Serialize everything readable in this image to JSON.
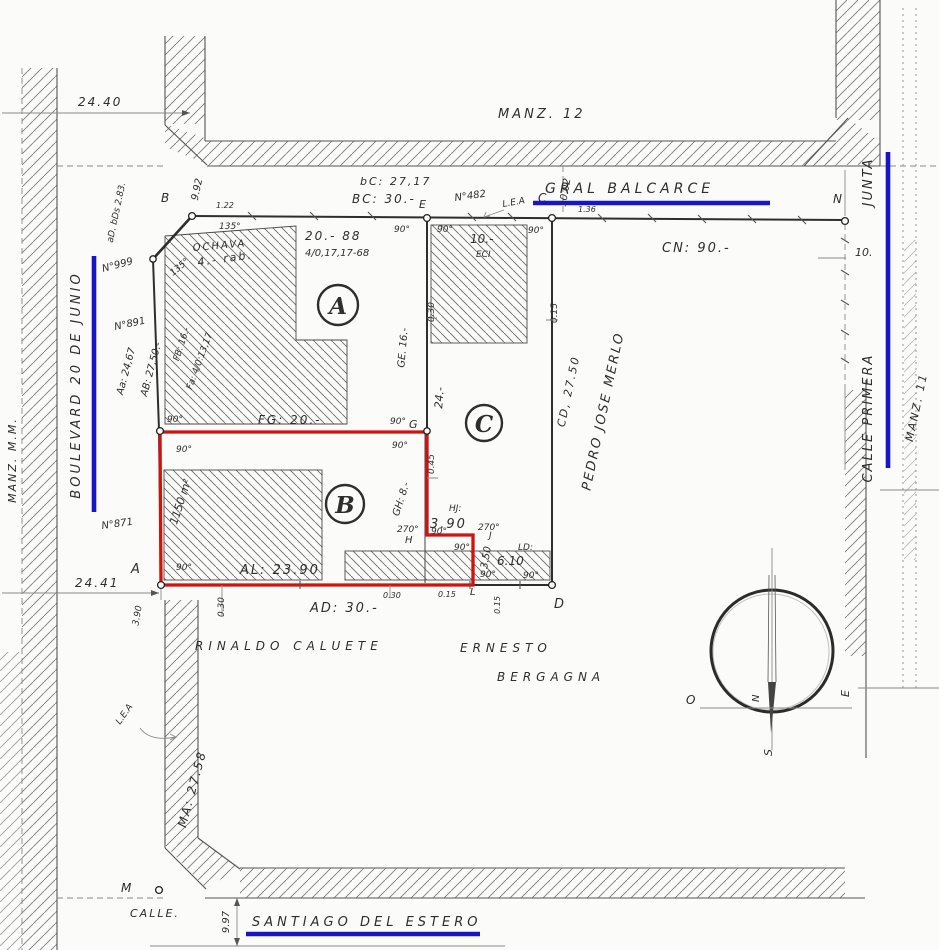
{
  "colors": {
    "red": "#cf1210",
    "blue": "#1616c8",
    "ink": "#2e2e2e",
    "faint": "#8a8a8a",
    "paper": "#fbfbfa"
  },
  "streets": {
    "gral_balcarce": "GRAL BALCARCE",
    "boulevard": "BOULEVARD 20 DE JUNIO",
    "santiago": "SANTIAGO DEL ESTERO",
    "primera_junta_upper": "JUNTA",
    "primera_junta_lower": "CALLE PRIMERA",
    "calle": "CALLE."
  },
  "blocks": {
    "manz12": "MANZ. 12",
    "manz11": "MANZ. 11",
    "manz14": "MANZ. M.M."
  },
  "owners": {
    "rinaldo": "RINALDO  CALUETE",
    "ernesto": "ERNESTO",
    "bergagna": "BERGAGNA",
    "merlo": "PEDRO JOSE MERLO"
  },
  "parcels": {
    "a": "A",
    "b": "B",
    "c": "C",
    "a_note1": "20.- 88",
    "a_note2": "4/0,17,17-68",
    "ochava1": "OCHAVA",
    "ochava2": "4.- rab.",
    "c_note1": "10.-",
    "c_note2": "ECI",
    "b_area": "1150 m²"
  },
  "segments": {
    "bc_lower": "bC: 27,17",
    "bc": "BC: 30.-",
    "cn": "CN: 90.-",
    "cd": "CD, 27.50",
    "ad": "AD: 30.-",
    "ab": "AB: 27,50.-",
    "aa": "Aa: 24,67",
    "fb": "FB: 16.-",
    "fa": "Fa: 4/0:13,17",
    "fg": "FG: 20.-",
    "ge": "GE. 16.-",
    "gh": "GH: 8.-",
    "hj": "HJ:",
    "ld": "LD:",
    "al": "AL: 23.90",
    "ma": "MA: 27.58",
    "c24": "24.-"
  },
  "dims": {
    "d2440": "24.40",
    "d2441": "24.41",
    "d992": "9.92",
    "d122": "1.22",
    "d1002": "10.02",
    "d136": "1.36",
    "d10": "10.",
    "d030": "0.30",
    "d015": "0.15",
    "d045": "0.45",
    "d997": "9.97",
    "d390": "3.90",
    "d390b": "3.90",
    "d350": "3.50",
    "d610": "6.10"
  },
  "points": {
    "A": "A",
    "B": "B",
    "C": "C",
    "D": "D",
    "E": "E",
    "G": "G",
    "H": "H",
    "J": "J",
    "L": "L",
    "M": "M",
    "N": "N"
  },
  "angles": {
    "a90": "90°",
    "a135": "135°",
    "a270": "270°"
  },
  "refs": {
    "n482": "N°482",
    "n999": "N°999",
    "n891": "N°891",
    "n871": "N°871",
    "adbds": "aD. bDs 2.83.",
    "lea": "L.E.A"
  },
  "compass": {
    "n": "N",
    "s": "S",
    "e": "E",
    "o": "O"
  }
}
